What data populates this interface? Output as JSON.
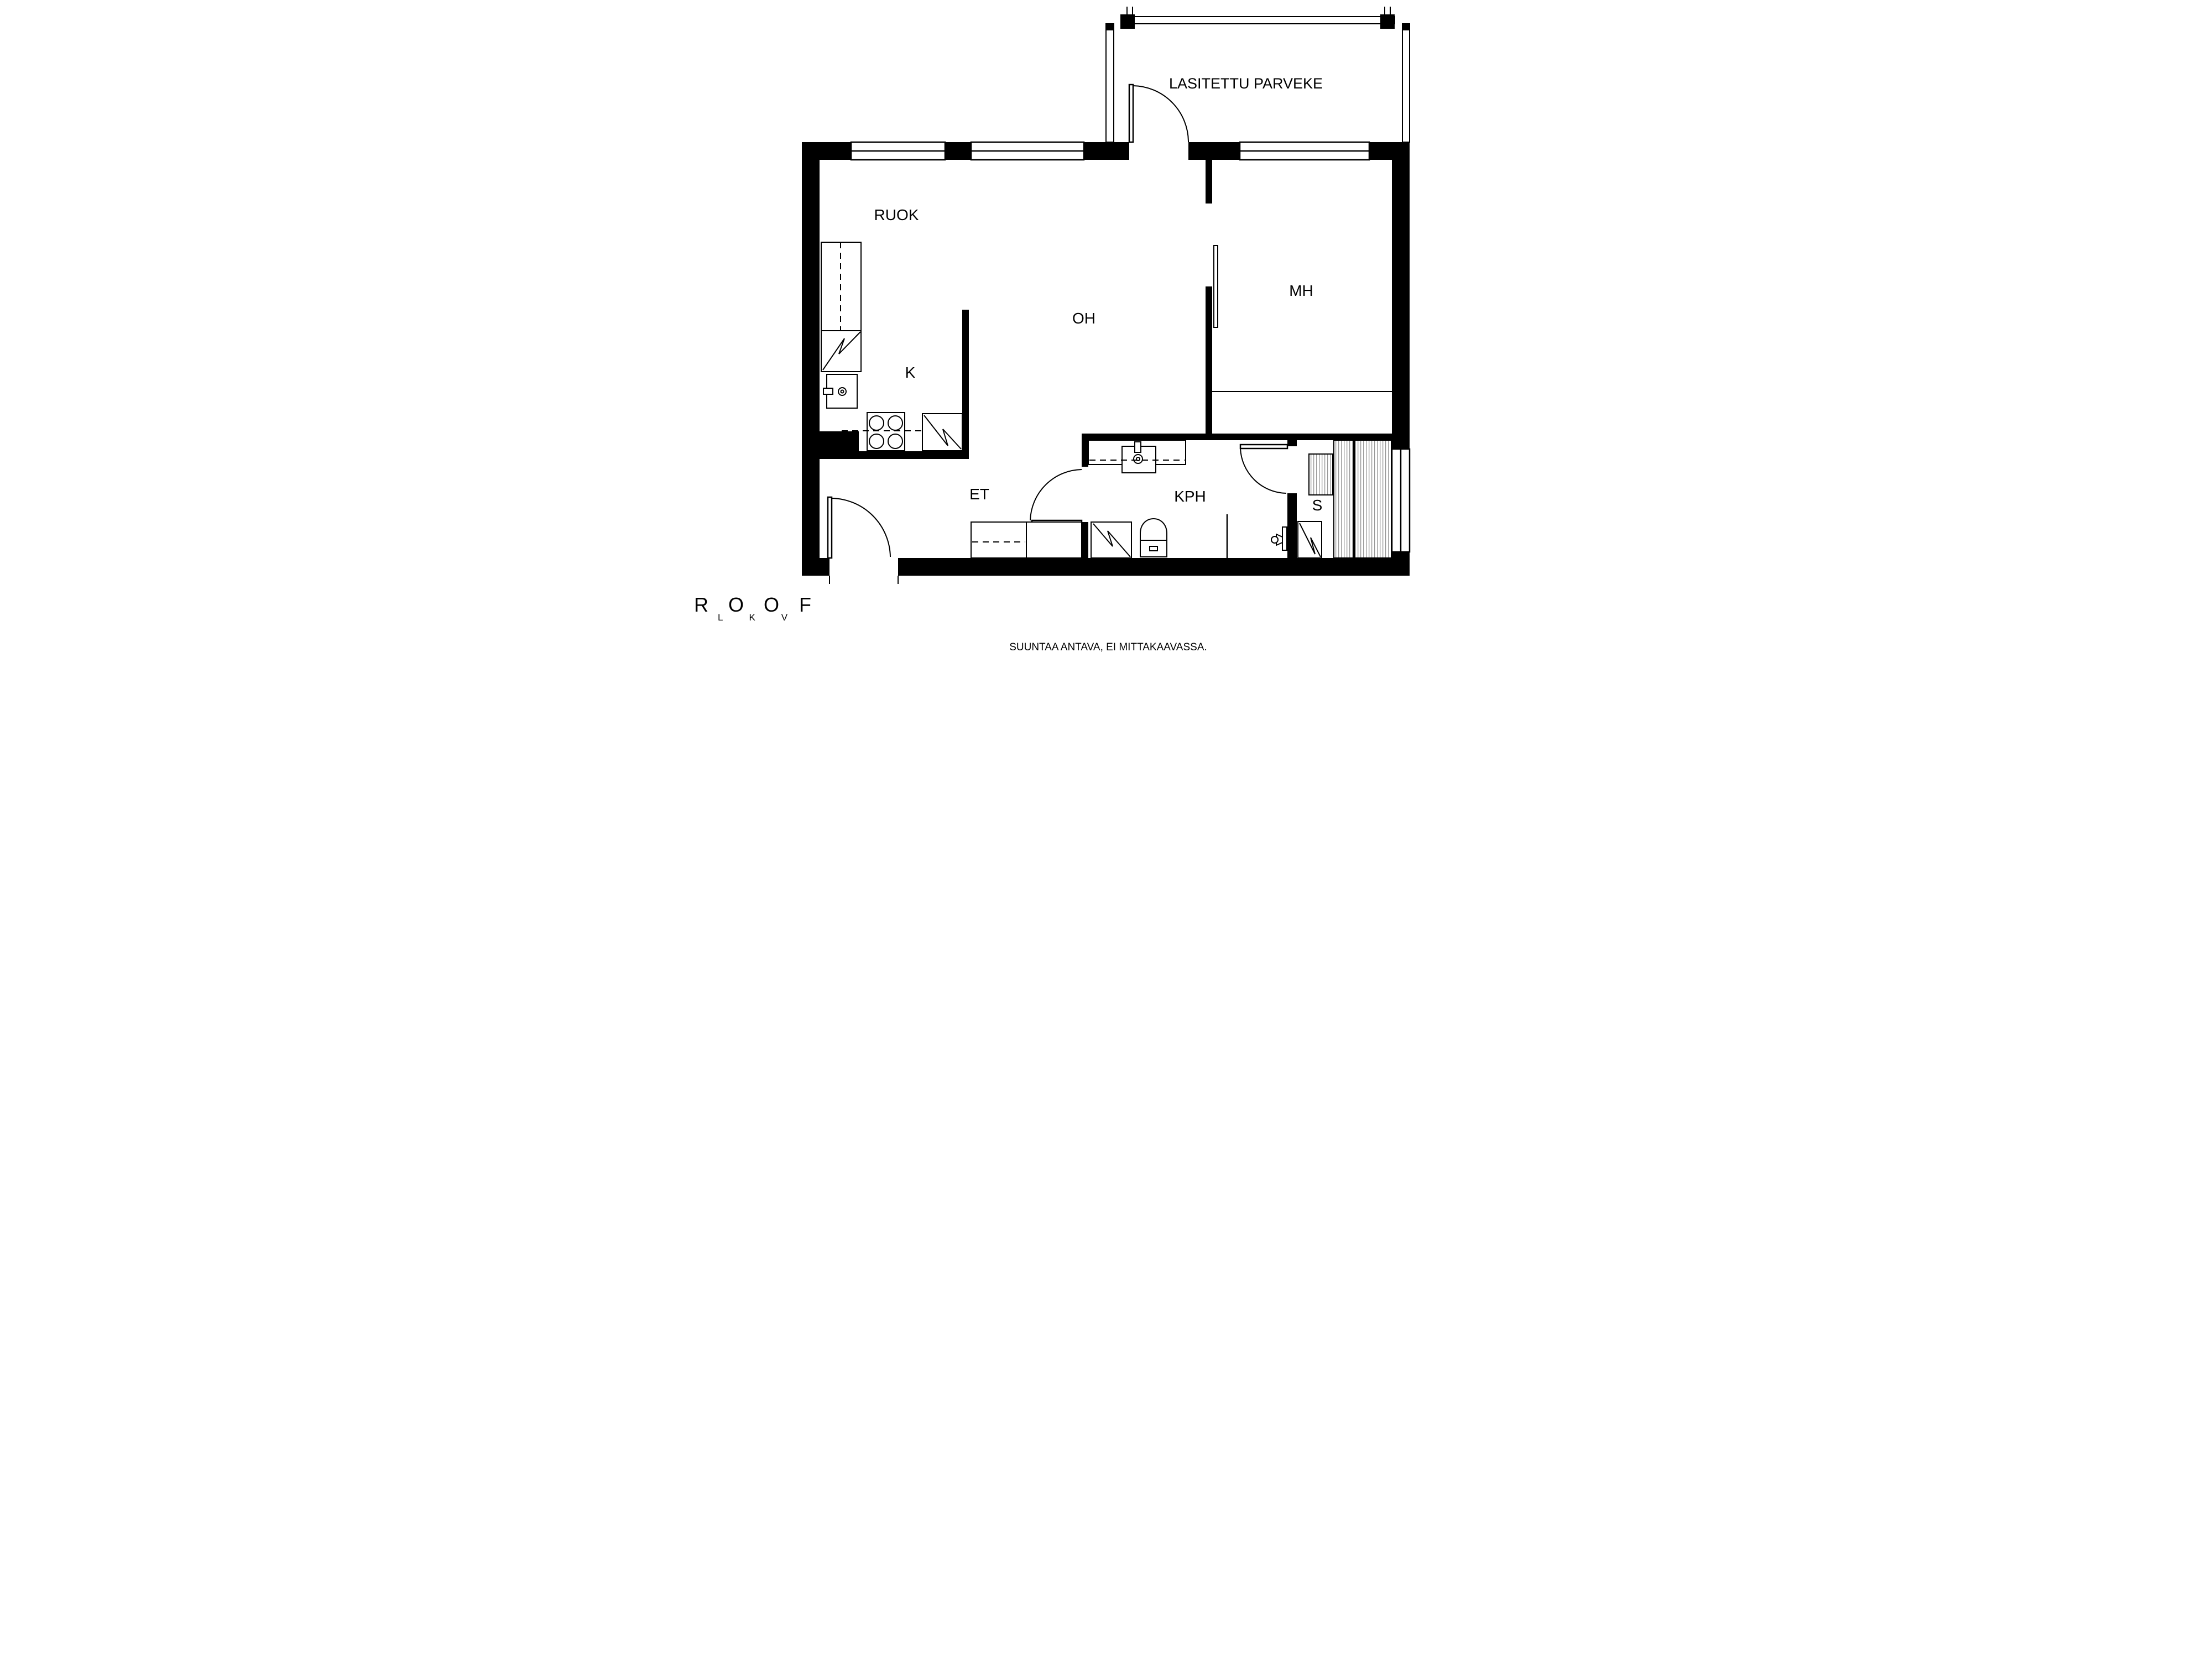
{
  "rooms": {
    "balcony": "LASITETTU PARVEKE",
    "dining": "RUOK",
    "kitchen": "K",
    "living_room": "OH",
    "bedroom": "MH",
    "entrance_hall": "ET",
    "bathroom": "KPH",
    "sauna": "S"
  },
  "footer": {
    "brand": "ROOF",
    "brand_letters": "LKV",
    "disclaimer": "SUUNTAA ANTAVA, EI MITTAKAAVASSA."
  },
  "colors": {
    "wall": "#000000",
    "background": "#ffffff",
    "hatch": "#8a8a8a"
  }
}
